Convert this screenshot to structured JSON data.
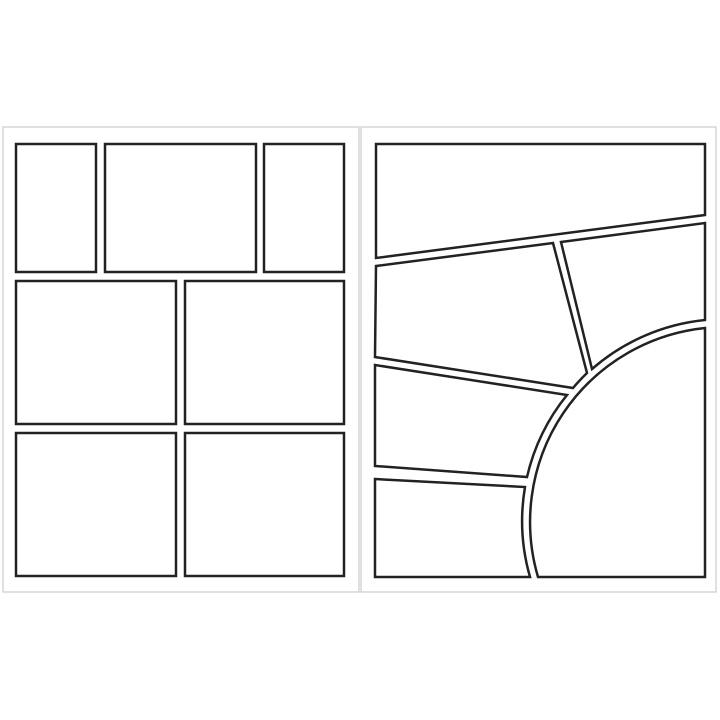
{
  "description": "Two blank comic book page templates shown side by side as a spread",
  "canvas": {
    "width": 720,
    "height": 720,
    "background_color": "#ffffff"
  },
  "colors": {
    "page_fill": "#ffffff",
    "page_stroke": "#cccccc",
    "panel_fill": "#ffffff",
    "panel_stroke": "#222222"
  },
  "stroke_widths": {
    "page": 1.2,
    "panel": 2.5
  },
  "pages": [
    {
      "id": "left",
      "layout": "grid",
      "panel_count": 7,
      "x": 3,
      "y": 127,
      "width": 356,
      "height": 465
    },
    {
      "id": "right",
      "layout": "radial",
      "panel_count": 6,
      "x": 361,
      "y": 127,
      "width": 355,
      "height": 465
    }
  ],
  "panels": [
    {
      "page": "left",
      "id": "left-panel-1-tall",
      "path": "M16,144 L96,144 L96,272 L16,272 Z"
    },
    {
      "page": "left",
      "id": "left-panel-2-wide",
      "path": "M105,144 L256,144 L256,272 L105,272 Z"
    },
    {
      "page": "left",
      "id": "left-panel-3-tall",
      "path": "M264,144 L344,144 L344,272 L264,272 Z"
    },
    {
      "page": "left",
      "id": "left-panel-4-mid-left",
      "path": "M16,281 L176,281 L176,424 L16,424 Z"
    },
    {
      "page": "left",
      "id": "left-panel-5-mid-right",
      "path": "M185,281 L344,281 L344,424 L185,424 Z"
    },
    {
      "page": "left",
      "id": "left-panel-6-bottom-left",
      "path": "M16,433 L176,433 L176,576 L16,576 Z"
    },
    {
      "page": "left",
      "id": "left-panel-7-bottom-right",
      "path": "M185,433 L344,433 L344,576 L185,576 Z"
    },
    {
      "page": "right",
      "id": "right-panel-1-top",
      "path": "M376,144 L705,144 L705,215 L376,258 Z"
    },
    {
      "page": "right",
      "id": "right-panel-2-band2-left",
      "path": "M376,266 L553,243 L587,373 A203,203 0 0 0 573,388 L375,357 Z"
    },
    {
      "page": "right",
      "id": "right-panel-3-band2-right",
      "path": "M561,242 L705,223 L705,320 A203,203 0 0 0 592,369 Z"
    },
    {
      "page": "right",
      "id": "right-panel-4-band3-left",
      "path": "M375,365 L567,395 A203,203 0 0 0 527,477 L375,466 Z"
    },
    {
      "page": "right",
      "id": "right-panel-5-bottom-left",
      "path": "M375,479 L525,487 A203,203 0 0 0 530,577 L375,577 Z"
    },
    {
      "page": "right",
      "id": "right-panel-6-arc",
      "path": "M705,328 A195,195 0 0 0 538,577 L705,577 Z"
    }
  ]
}
